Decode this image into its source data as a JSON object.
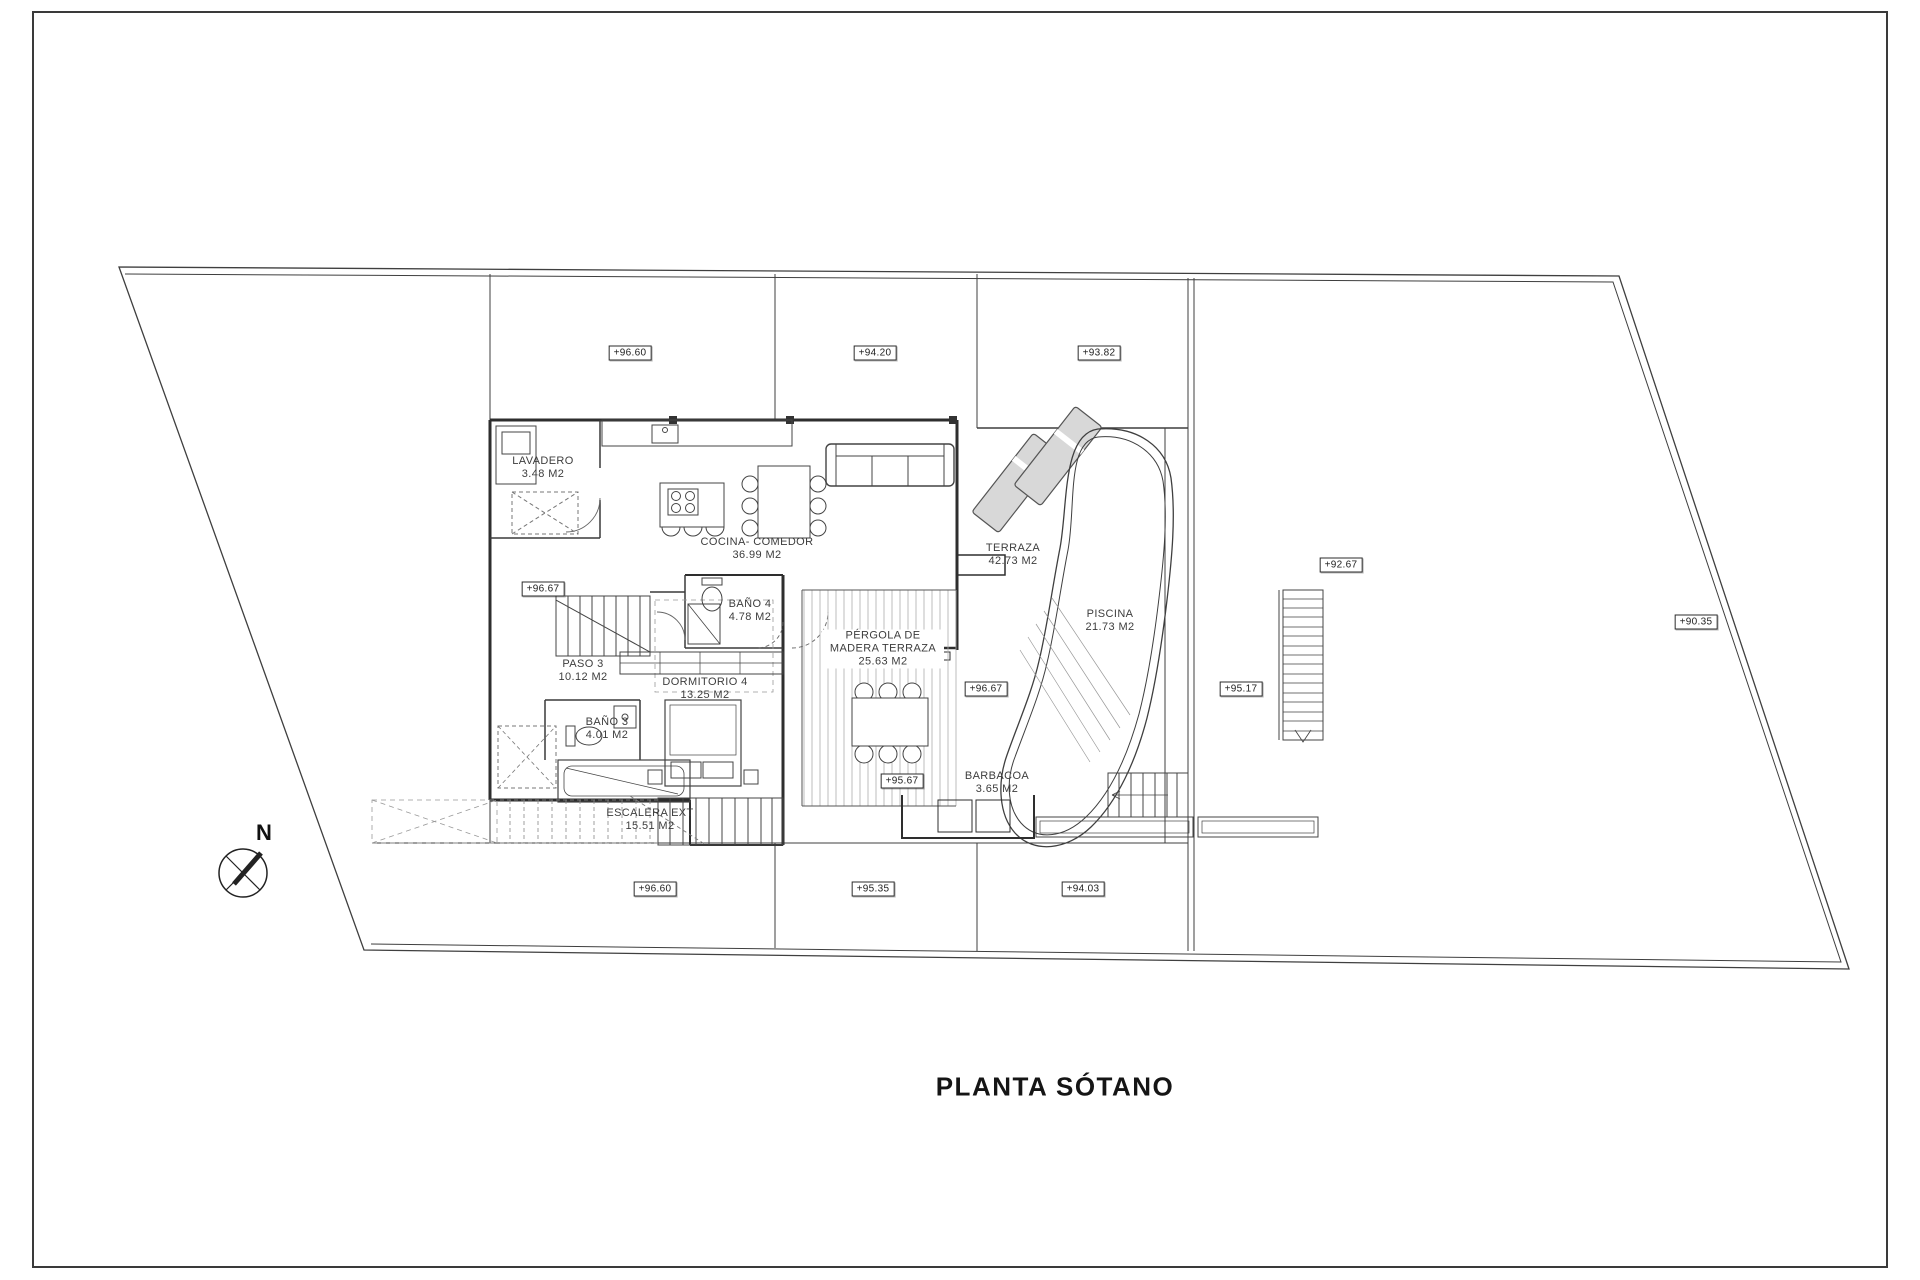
{
  "title": "PLANTA SÓTANO",
  "north_label": "N",
  "rooms": [
    {
      "name": "LAVADERO",
      "area": "3.48 M2"
    },
    {
      "name": "COCINA- COMEDOR",
      "area": "36.99 M2"
    },
    {
      "name": "BAÑO 4",
      "area": "4.78 M2"
    },
    {
      "name": "PASO 3",
      "area": "10.12 M2"
    },
    {
      "name": "DORMITORIO 4",
      "area": "13.25 M2"
    },
    {
      "name": "BAÑO 3",
      "area": "4.01 M2"
    },
    {
      "name": "ESCALERA EXT",
      "area": "15.51 M2"
    },
    {
      "name": "PÉRGOLA DE MADERA TERRAZA",
      "area": "25.63 M2"
    },
    {
      "name": "TERRAZA",
      "area": "42.73 M2"
    },
    {
      "name": "PISCINA",
      "area": "21.73 M2"
    },
    {
      "name": "BARBACOA",
      "area": "3.65 M2"
    }
  ],
  "elevations": [
    "+96.60",
    "+94.20",
    "+93.82",
    "+92.67",
    "+90.35",
    "+96.67",
    "+96.67",
    "+95.17",
    "+95.67",
    "+96.60",
    "+95.35",
    "+94.03"
  ]
}
